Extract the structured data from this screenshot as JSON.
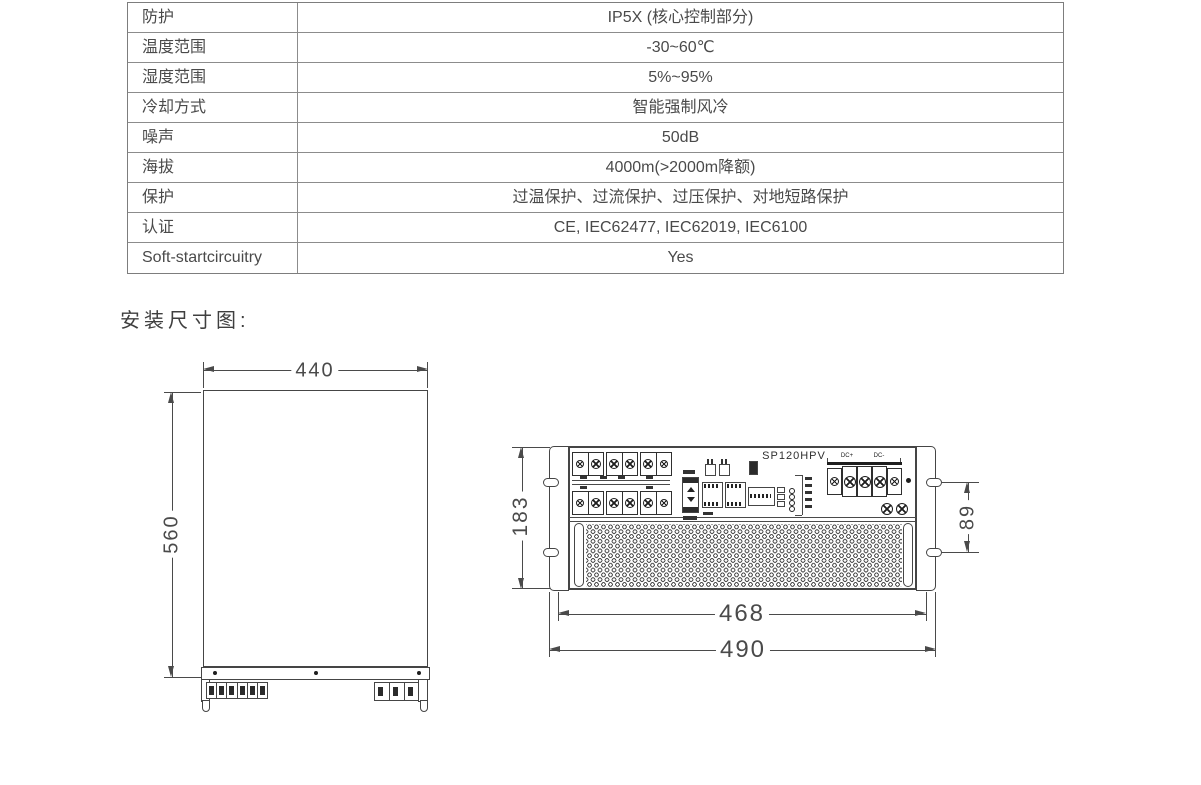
{
  "spec_table": {
    "rows": [
      {
        "label": "防护",
        "value": "IP5X (核心控制部分)"
      },
      {
        "label": "温度范围",
        "value": "-30~60℃"
      },
      {
        "label": "湿度范围",
        "value": "5%~95%"
      },
      {
        "label": "冷却方式",
        "value": "智能强制风冷"
      },
      {
        "label": "噪声",
        "value": "50dB"
      },
      {
        "label": "海拔",
        "value": "4000m(>2000m降额)"
      },
      {
        "label": "保护",
        "value": "过温保护、过流保护、过压保护、对地短路保护"
      },
      {
        "label": "认证",
        "value": "CE, IEC62477, IEC62019, IEC6100"
      },
      {
        "label": "Soft-startcircuitry",
        "value": "Yes"
      }
    ]
  },
  "section_title": "安装尺寸图:",
  "top_view": {
    "width_dim": "440",
    "height_dim": "560"
  },
  "front_view": {
    "model": "SP120HPV",
    "height_dim": "183",
    "slot_spacing_dim": "89",
    "body_width_dim": "468",
    "overall_width_dim": "490",
    "terminal_label_pos": "DC+",
    "terminal_label_neg": "DC-"
  }
}
